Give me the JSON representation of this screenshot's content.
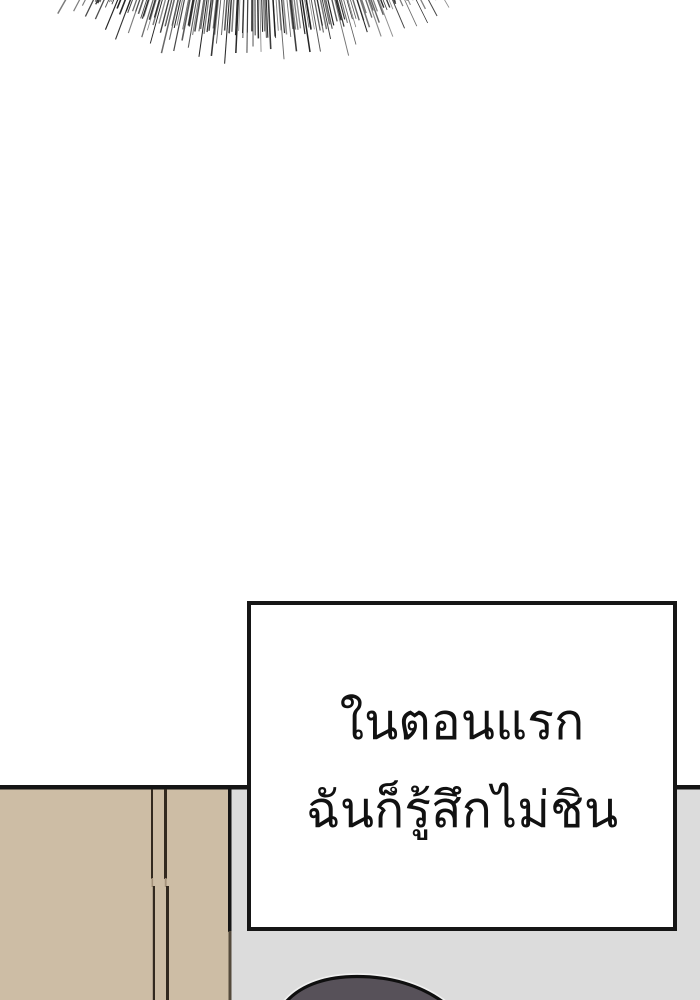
{
  "page": {
    "width": 700,
    "height": 1000,
    "background": "#ffffff",
    "kind": "webtoon comic panel"
  },
  "speech_box": {
    "lines": [
      "ในตอนแรก",
      "ฉันก็รู้สึกไม่ชิน"
    ],
    "border_color": "#161616",
    "background": "#ffffff",
    "text_color": "#111111"
  },
  "scene": {
    "colors": {
      "wardrobe_beige": "#cdbda5",
      "wall_gray": "#dcdcdc",
      "outline_black": "#151515",
      "seam_dark": "#32291f",
      "seam_faint": "#a4927b",
      "boundary_lower": "#544a3c",
      "head_fill": "#575159",
      "head_outline": "#0f0f0f",
      "head_halo": "#f0f0f0"
    }
  },
  "artwork": {
    "hatch": {
      "description": "curved fringe of fine radial speed-line hatching along top edge",
      "color": "#202020",
      "cx": 253,
      "cy": -329,
      "angle_start": -31.5,
      "angle_end": 31.5,
      "count": 175,
      "r_inner": 318,
      "r_base": 364,
      "long_every": 5,
      "seed": 9
    }
  }
}
